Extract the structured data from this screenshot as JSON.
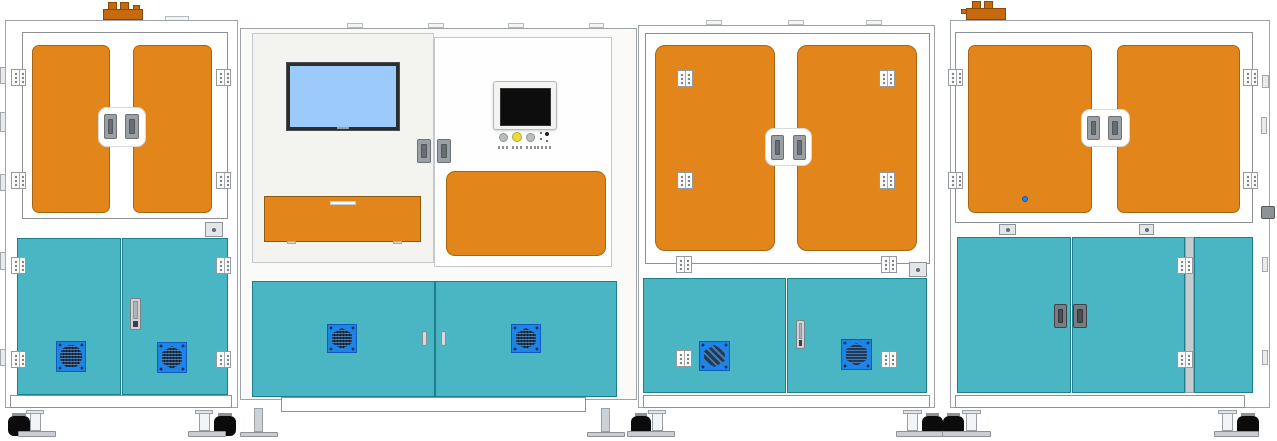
{
  "title": "Four-module industrial automation machine line - technical elevation drawing",
  "colors": {
    "door_orange": "#E2861B",
    "cap_orange": "#C76A0D",
    "panel_teal": "#4AB5C3",
    "teal_border": "#1F7E8C",
    "vent_blue": "#1E85E8",
    "grill_dark": "#1C3A5E",
    "screen_blue": "#9CCAFB",
    "hmi_black": "#0D0D0D",
    "button_gray": "#B9BDBF",
    "button_yellow": "#E9DC3E",
    "caster_black": "#0B0B0B",
    "frame_border": "#9EA3A7"
  },
  "machine": {
    "modules": [
      {
        "name": "left-cabinet",
        "upper": "two orange doors with frame hinges and twin grip handles",
        "lower": "two teal doors with two fan vents and cam lock",
        "roof": "orange exhaust cap",
        "feet": "caster wheels with leveling pads"
      },
      {
        "name": "control-station",
        "left_bay": "blue display screen above orange pull-out drawer",
        "right_bay": "HMI panel with indicator buttons above orange access panel",
        "lower": "two teal doors with two fan vents",
        "feet": "fixed support legs"
      },
      {
        "name": "middle-cabinet",
        "upper": "two orange doors with surface hinges",
        "lower": "two teal doors with two fan vents and cam lock",
        "feet": "caster wheels with leveling pads"
      },
      {
        "name": "right-cabinet",
        "upper": "two orange doors with frame hinges",
        "lower": "three teal doors with grip handles",
        "roof": "orange exhaust cap",
        "feet": "caster wheels with leveling pads"
      }
    ],
    "main_display": {
      "screen_state": "blank-blue"
    },
    "hmi": {
      "screen_state": "off-black",
      "buttons": [
        {
          "name": "indicator-button-1",
          "color": "#B9BDBF"
        },
        {
          "name": "indicator-button-2",
          "color": "#E9DC3E"
        },
        {
          "name": "indicator-button-3",
          "color": "#B9BDBF"
        },
        {
          "name": "selector-switch",
          "color": "#2B2B2B"
        }
      ]
    }
  }
}
